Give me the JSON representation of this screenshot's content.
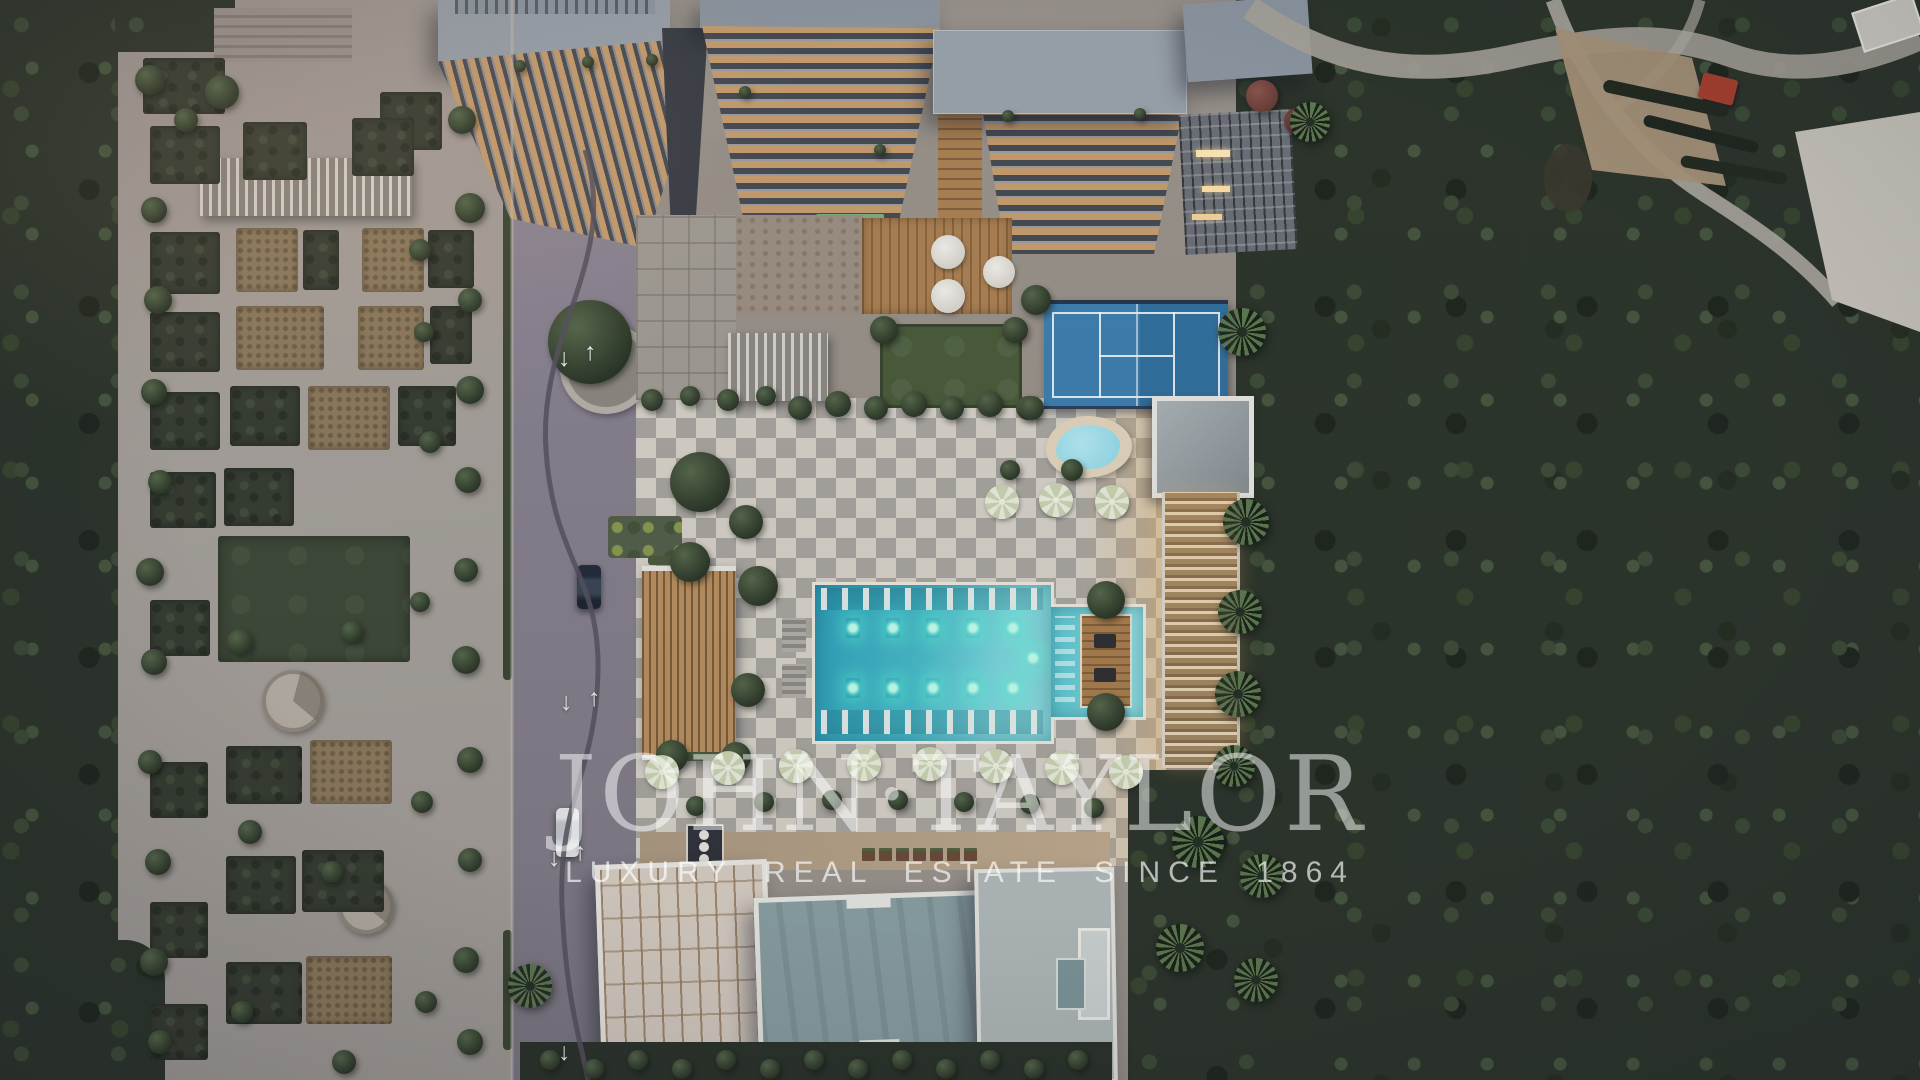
{
  "watermark": {
    "brand": "JOHN·TAYLOR",
    "tagline": "LUXURY REAL ESTATE SINCE 1864"
  },
  "palette": {
    "forest_base": "#2c352b",
    "forest_dark": "#1f271e",
    "forest_light": "#3d4c37",
    "park_pavement": "#a7a29b",
    "park_lawn": "#3f4a38",
    "planter_dark": "#363d31",
    "planter_tan": "#8d7a5c",
    "road": "#8a8391",
    "checker_light": "#d7d3c9",
    "checker_dark": "#a9a6a0",
    "pool_deep": "#2fa2bc",
    "pool_light": "#8fdfe2",
    "pool_glow": "#5cffd6",
    "court_blue": "#3e80b0",
    "court_blue_dark": "#32719f",
    "wood": "#b9905f",
    "wood_deck": "#ad8253",
    "roof_gray": "#9aa3ac",
    "roof_teal": "#8ba1a3",
    "roof_cream": "#d8cfc3",
    "balcony_amber": "#c79e6e",
    "umbrella": "#cbd5b2",
    "tree_hi": "#56694b",
    "tree_lo": "#2f3b2a",
    "palm_frond": "#5d7a4f",
    "wm_color": "rgba(255,255,255,0.50)",
    "wm_tag_color": "rgba(255,255,255,0.66)"
  }
}
